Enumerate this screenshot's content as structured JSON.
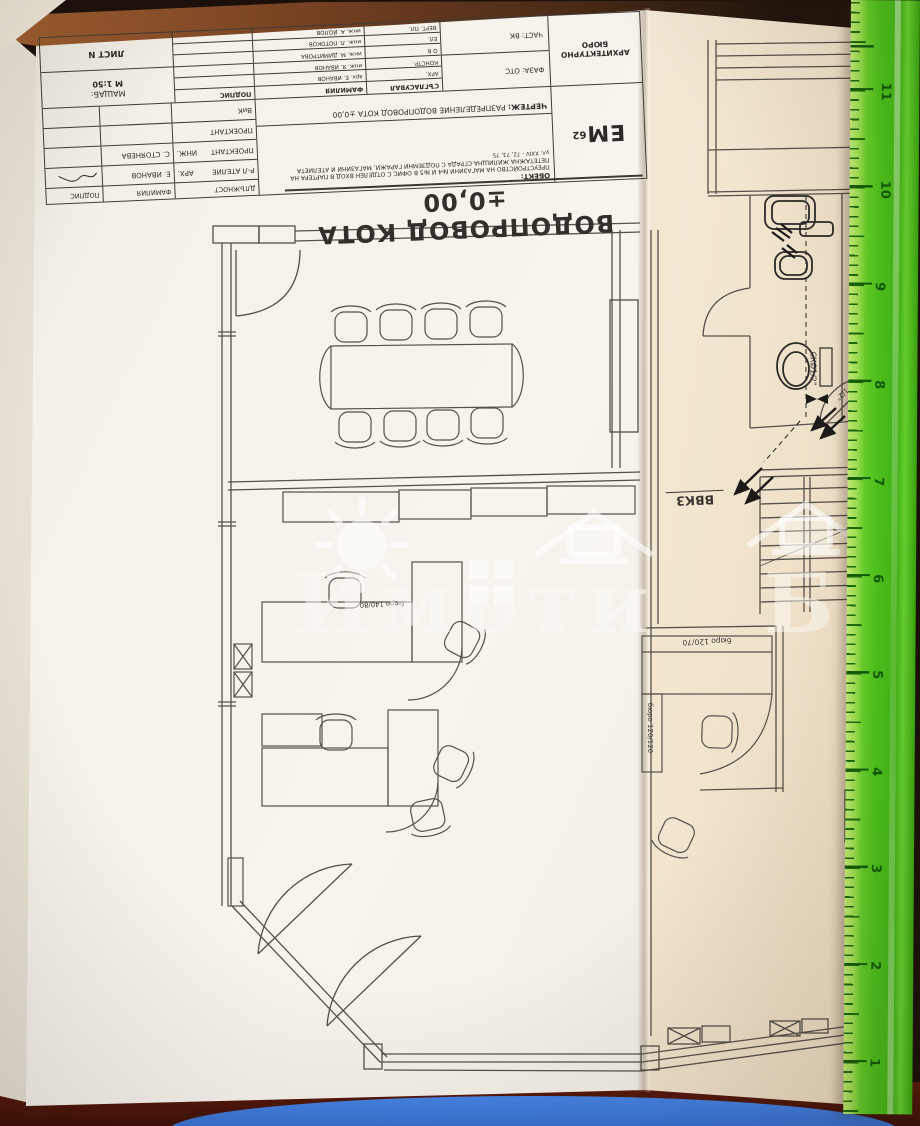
{
  "scene": {
    "watermark": {
      "brand": "Имоти БГ"
    },
    "ruler": {
      "unit_numbers": [
        "11",
        "10",
        "9",
        "8",
        "7",
        "6",
        "5",
        "4",
        "3",
        "2",
        "1"
      ]
    }
  },
  "plan_labels": {
    "main_title": "ВОДОПРОВОД КОТА ±0,00",
    "riser_label": "ВВК3",
    "pipe_size_label": "СКØ1/2\"",
    "pipe_size_label_2": "1/2\"",
    "desk_label_1": "бюро 120/70",
    "desk_label_2": "бюро 120/120",
    "desk_label_3": "бюро 140/80"
  },
  "titleblock": {
    "logo_text": "ЕМ",
    "logo_sup": "62",
    "object_label": "ОБЕКТ:",
    "object_line1": "ПРЕУСТРОЙСТВО НА МАГАЗИНИ №4 И №5 В ОФИС С ОТДЕЛЕН ВХОД В ПАРТЕРА НА",
    "object_line2": "ПЕТЕТАЖНА ЖИЛИЩНА СГРАДА С ПОДЗЕМНИ ГАРАЖИ, МАГАЗИНИ И АТЕЛИЕТА",
    "object_line3": "ул. XXIV - 72, 73, 75",
    "drawing_label": "ЧЕРТЕЖ:",
    "drawing_name": "РАЗПРЕДЕЛЕНИЕ ВОДОПРОВОД КОТА ±0,00",
    "bureau_line1": "АРХИТЕКТУРНО",
    "bureau_line2": "БЮРО",
    "phase": "ФАЗА: ОТС",
    "part": "ЧАСТ: ВК",
    "scale_label": "МАЩАБ:",
    "scale_value": "М 1:50",
    "sheet_label": "ЛИСТ N",
    "header_role": "ДЛЪЖНОСТ",
    "header_family": "ФАМИЛИЯ",
    "header_sign": "ПОДПИС",
    "header_agreed": "СЪГЛАСУВАЛ",
    "staff_rows": [
      {
        "role": "Р-Л АТЕЛИЕ",
        "grade": "АРХ.",
        "name": "Е. ИВАНОВ"
      },
      {
        "role": "ПРОЕКТАНТ",
        "grade": "ИНЖ.",
        "name": "С. СТОЯНЕВА"
      },
      {
        "role": "ПРОЕКТАНТ",
        "grade": "",
        "name": ""
      },
      {
        "role": "ВиК",
        "grade": "",
        "name": ""
      }
    ],
    "agreed_rows": [
      {
        "discipline": "АРХ.",
        "name": "арх. Е. ИВАНОВ"
      },
      {
        "discipline": "КОНСТР.",
        "name": "инж. Я. ИВАНОВ"
      },
      {
        "discipline": "О В",
        "name": "инж. М. ДИМИТРОВА"
      },
      {
        "discipline": "ЕЛ.",
        "name": "инж. Л. ПОТОКОВ"
      },
      {
        "discipline": "ВЕРТ. ПЛ.",
        "name": "инж. А. ЙОЛОВ"
      }
    ]
  },
  "colors": {
    "ruler_green": "#4cc31c",
    "paper": "#f4f1ea",
    "paper_fold": "#f2e7d1",
    "ink": "#54504a",
    "backdrop_brown": "#1b110a",
    "table_red": "#5e1a0e",
    "accent_blue": "#2f6fd6"
  }
}
